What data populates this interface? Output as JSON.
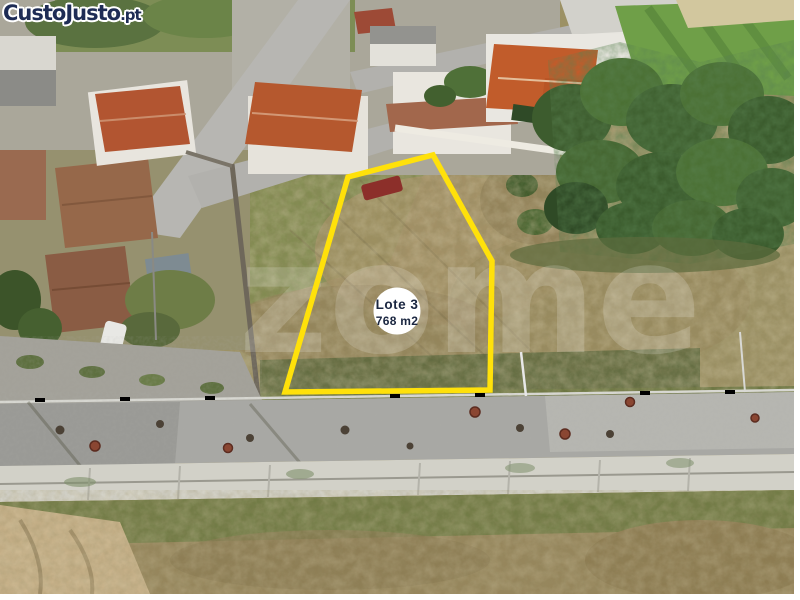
{
  "brand": {
    "name": "CustoJusto",
    "tld": ".pt"
  },
  "plot": {
    "name": "Lote 3",
    "area": "768 m2"
  },
  "watermark": {
    "text": "zome"
  },
  "colors": {
    "plot_outline": "#FFE10A",
    "brand_navy": "#1E2C55",
    "badge_bg": "#FFFFFF",
    "badge_text": "#1A2640"
  }
}
